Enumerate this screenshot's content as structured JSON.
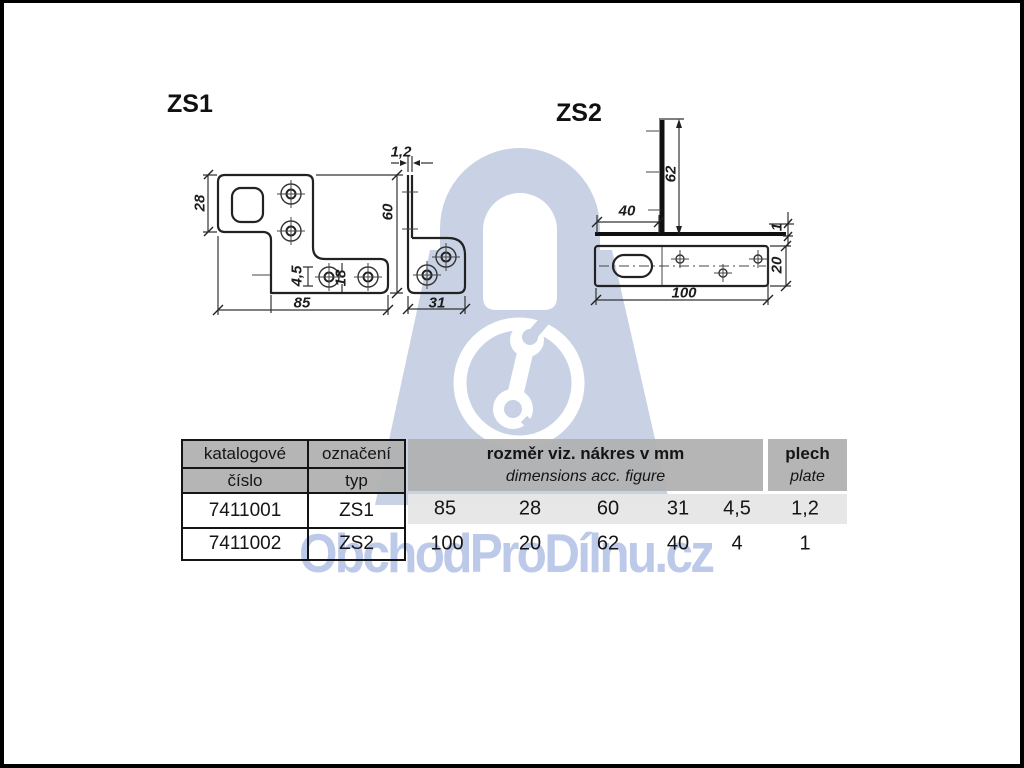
{
  "page": {
    "frame_color": "#000000",
    "background": "#ffffff"
  },
  "drawings": {
    "zs1": {
      "label": "ZS1",
      "dims": {
        "width": "85",
        "top_height": "28",
        "height": "60",
        "thickness": "1,2",
        "hole_diameter": "4,5",
        "hole_spacing": "18",
        "flange_width": "31"
      }
    },
    "zs2": {
      "label": "ZS2",
      "dims": {
        "length": "100",
        "width": "20",
        "height": "62",
        "foot": "40",
        "thickness": "1"
      }
    }
  },
  "watermark": {
    "text": "ObchodProDílnu.cz",
    "lock_color": "#c9d2e5",
    "text_color": "#bcc9e8",
    "icon": "wrench-icon"
  },
  "table": {
    "header_gray": "#b1b1b1",
    "row_stripe_gray": "#e6e6e6",
    "col1": {
      "line1": "katalogové",
      "line2": "číslo"
    },
    "col2": {
      "line1": "označení",
      "line2": "typ"
    },
    "dims_header": {
      "line1": "rozměr viz. nákres v mm",
      "line2": "dimensions acc. figure"
    },
    "plate_header": {
      "line1": "plech",
      "line2": "plate"
    },
    "rows": [
      {
        "catalog": "7411001",
        "type": "ZS1",
        "dims": [
          "85",
          "28",
          "60",
          "31",
          "4,5"
        ],
        "plate": "1,2"
      },
      {
        "catalog": "7411002",
        "type": "ZS2",
        "dims": [
          "100",
          "20",
          "62",
          "40",
          "4"
        ],
        "plate": "1"
      }
    ]
  }
}
